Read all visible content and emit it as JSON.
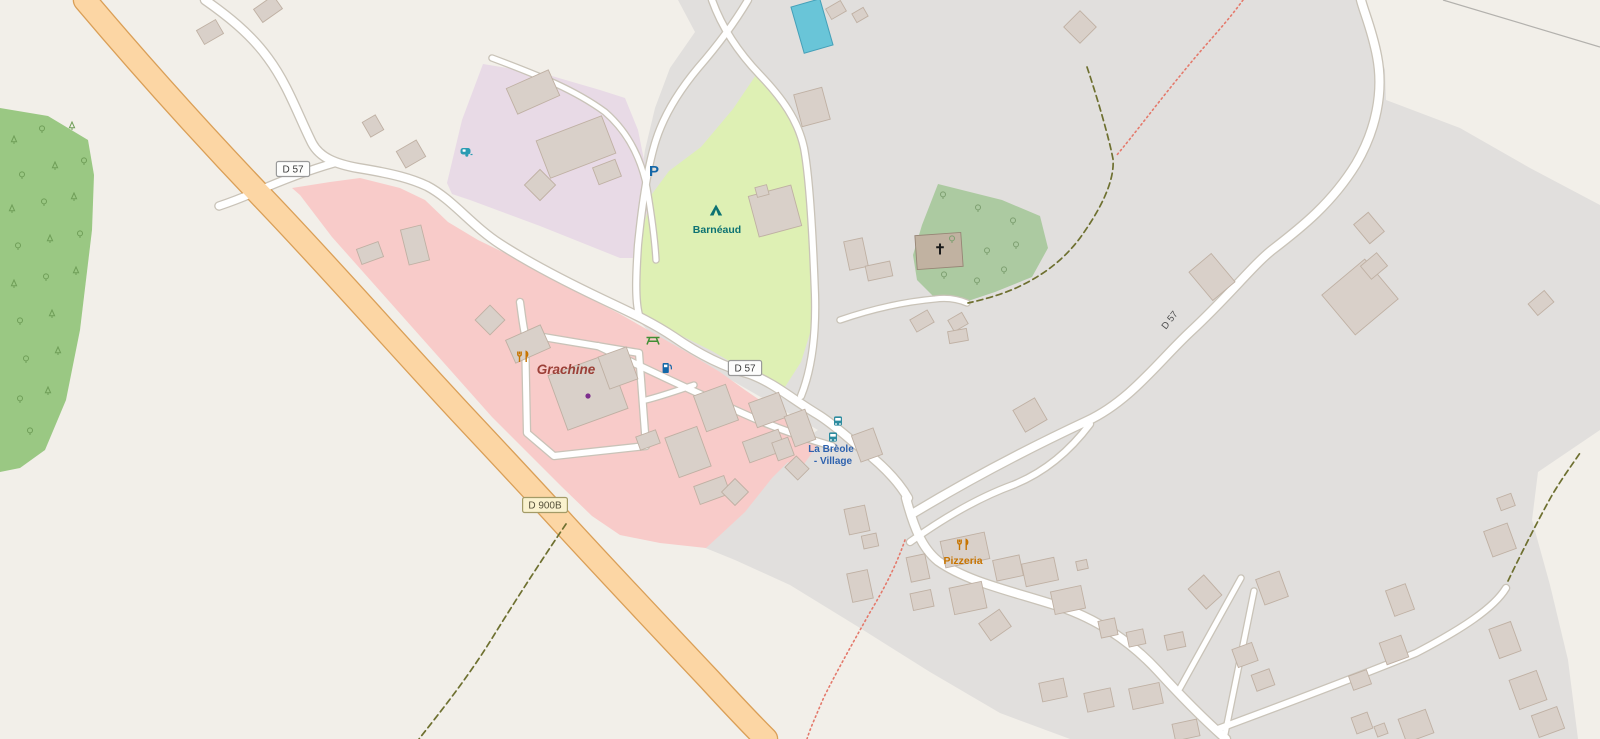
{
  "map": {
    "background": "#f2efe9",
    "building_style": {
      "fill": "#d9d0c9",
      "stroke": "#bfb0a3",
      "church_fill": "#c1b2a1",
      "church_stroke": "#968575"
    },
    "landuse": [
      {
        "name": "residential-gray",
        "fill": "#e1dfdd",
        "points": "678,0 1360,0 1374,35 1385,70 1386,100 1460,128 1530,168 1600,205 1600,430 1538,472 1532,520 1550,585 1568,660 1578,739 1070,739 1000,713 930,672 860,628 790,585 735,560 703,547 780,462 800,442 818,430 790,414 745,388 700,362 655,338 636,318 634,260 638,200 645,150 655,108 670,68 695,32"
      },
      {
        "name": "forest",
        "fill": "#9ac883",
        "points": "0,108 48,116 88,140 94,175 92,230 80,330 66,400 45,450 20,468 0,472"
      },
      {
        "name": "pink-hamlet",
        "fill": "#f8cbc9",
        "points": "292,188 330,182 360,178 400,188 425,200 448,222 478,240 515,258 550,276 585,296 620,314 655,334 690,354 720,372 745,390 770,407 790,422 806,434 818,444 800,470 788,462 772,478 745,512 718,537 706,548 660,543 620,535 592,516 562,487 527,452 492,417 452,372 412,327 372,282 332,237 300,195"
      },
      {
        "name": "lavender-caravan-site",
        "fill": "#e8dae6",
        "points": "483,64 545,74 600,90 625,98 638,130 648,180 656,228 657,258 620,258 540,226 470,200 452,194 447,183 462,120"
      },
      {
        "name": "camp-site-green",
        "fill": "#def0b4",
        "points": "758,72 786,112 800,142 807,172 811,232 813,290 811,330 801,362 783,390 755,376 712,351 668,329 641,315 635,294 640,240 652,194 669,171 701,147 733,109"
      },
      {
        "name": "church-wood",
        "fill": "#accaa1",
        "points": "938,184 1002,200 1040,216 1048,248 1032,277 995,292 965,302 935,298 917,280 913,255 922,225"
      }
    ],
    "pool": {
      "x": 797,
      "y": 2,
      "w": 30,
      "h": 48,
      "rot": -16,
      "fill": "#69c5d8",
      "stroke": "#45a0b8"
    },
    "powerline": {
      "x1": 1443,
      "y1": 0,
      "x2": 1600,
      "y2": 47,
      "color": "#b3b1ad"
    },
    "roads": [
      {
        "name": "d57-west",
        "d": "M 205,0 C 225,14 250,33 268,58 C 288,85 298,115 312,143 C 320,158 336,164 358,168 C 395,174 412,179 427,186 C 452,199 472,226 500,244 C 528,262 562,280 602,299 C 627,311 650,321 674,337 C 697,353 724,367 750,374 C 774,383 792,399 817,414 C 832,423 847,437 862,449 C 880,463 897,479 908,498",
        "width": 8
      },
      {
        "name": "d57-branch-to-d900b",
        "d": "M 334,163 C 306,171 276,183 253,193 C 239,199 228,203 219,206",
        "width": 7
      },
      {
        "name": "d57-northeast",
        "d": "M 912,514 C 950,491 1012,456 1087,421 C 1130,401 1158,362 1190,332 C 1228,297 1252,266 1272,250 C 1302,227 1332,203 1356,164 C 1376,130 1384,92 1377,56 C 1372,30 1364,12 1361,0",
        "width": 8
      },
      {
        "name": "village-southeast",
        "d": "M 906,498 C 914,528 922,548 938,561 C 968,582 1008,590 1058,606 C 1100,620 1133,644 1158,671 C 1178,693 1198,714 1226,739",
        "width": 8
      },
      {
        "name": "village-ne-link",
        "d": "M 910,542 C 945,517 980,497 1013,485 C 1048,471 1072,448 1090,424",
        "width": 6
      },
      {
        "name": "grachine-link",
        "d": "M 598,346 C 640,366 692,391 742,413 C 777,429 808,439 832,446",
        "width": 6
      },
      {
        "name": "grachine-loop",
        "d": "M 520,302 C 522,316 523,326 525,334 L 639,353 L 646,446 L 554,456 L 527,433 L 525,334",
        "width": 6
      },
      {
        "name": "grachine-spur",
        "d": "M 646,400 C 662,396 676,391 694,385",
        "width": 5
      },
      {
        "name": "camp-east-lane",
        "d": "M 712,0 C 722,28 738,52 760,75 C 782,98 798,120 804,148 C 810,180 813,240 815,295 C 816,330 813,366 801,396",
        "width": 6
      },
      {
        "name": "camp-west-lane",
        "d": "M 748,0 C 735,22 718,45 698,68 C 678,92 664,115 656,140 C 648,165 642,205 638,245 C 636,275 635,300 639,315",
        "width": 6
      },
      {
        "name": "caravan-site-lane",
        "d": "M 492,58 C 540,76 575,90 605,112 C 628,132 641,158 647,188 C 652,218 655,242 656,260",
        "width": 5
      },
      {
        "name": "church-lane",
        "d": "M 840,320 C 872,309 902,302 935,299 C 950,297 960,300 967,303",
        "width": 5
      },
      {
        "name": "branch-a",
        "d": "M 1180,688 L 1241,578",
        "width": 5
      },
      {
        "name": "branch-b",
        "d": "M 1224,739 L 1254,591",
        "width": 5
      },
      {
        "name": "se-deadend-lane",
        "d": "M 1218,729 C 1280,706 1352,679 1416,653 C 1462,629 1494,608 1506,588",
        "width": 6
      },
      {
        "name": "d900b-primary",
        "d": "M 85,0 C 140,65 200,132 265,200 C 330,268 395,342 460,412 C 505,460 535,492 565,525 C 610,574 660,627 710,680 C 733,705 752,725 766,739",
        "width": 22,
        "fill": "#fcd6a4",
        "casing": "#da9f57"
      }
    ],
    "tracks": [
      {
        "name": "footpath-northeast",
        "d": "M 1243,0 C 1225,25 1204,46 1184,71 C 1159,101 1133,136 1116,156",
        "color": "#e4796b",
        "dash": "1.5,3.2",
        "width": 1.6
      },
      {
        "name": "track-church-hill",
        "d": "M 1087,67 C 1098,100 1109,138 1113,159 C 1115,183 1098,213 1080,238 C 1062,262 1040,277 1016,288 C 1000,295 982,300 968,303",
        "color": "#6e7030",
        "dash": "6,4",
        "width": 1.7
      },
      {
        "name": "footpath-south",
        "d": "M 905,540 C 896,566 884,589 869,614 C 854,641 839,667 824,697 C 815,718 810,729 807,739",
        "color": "#e4796b",
        "dash": "1.5,3.2",
        "width": 1.6
      },
      {
        "name": "track-southwest",
        "d": "M 566,524 C 541,561 515,601 491,640 C 466,680 441,711 419,739",
        "color": "#6e7030",
        "dash": "6,4",
        "width": 1.7
      },
      {
        "name": "track-southeast",
        "d": "M 1508,581 C 1520,556 1536,524 1551,497 C 1562,478 1572,465 1580,453",
        "color": "#6e7030",
        "dash": "6,4",
        "width": 1.7
      }
    ],
    "buildings": [
      [
        268,
        9,
        24,
        16,
        -35
      ],
      [
        210,
        32,
        22,
        16,
        -30
      ],
      [
        373,
        126,
        15,
        17,
        -30
      ],
      [
        411,
        154,
        23,
        19,
        -30
      ],
      [
        533,
        92,
        46,
        28,
        -24
      ],
      [
        576,
        147,
        70,
        40,
        -21
      ],
      [
        607,
        172,
        24,
        18,
        -21
      ],
      [
        540,
        185,
        22,
        22,
        45
      ],
      [
        812,
        107,
        29,
        33,
        -15
      ],
      [
        836,
        10,
        17,
        12,
        -30
      ],
      [
        860,
        15,
        13,
        10,
        -30
      ],
      [
        775,
        211,
        44,
        42,
        -15
      ],
      [
        762,
        191,
        12,
        10,
        -15
      ],
      [
        1080,
        27,
        23,
        23,
        45
      ],
      [
        1212,
        277,
        29,
        37,
        -40
      ],
      [
        1360,
        297,
        56,
        52,
        -40
      ],
      [
        1374,
        266,
        21,
        17,
        -40
      ],
      [
        1369,
        228,
        19,
        25,
        -40
      ],
      [
        1541,
        303,
        21,
        15,
        -40
      ],
      [
        856,
        254,
        19,
        29,
        -12
      ],
      [
        879,
        271,
        25,
        15,
        -12
      ],
      [
        922,
        321,
        20,
        14,
        -30
      ],
      [
        958,
        322,
        16,
        13,
        -30
      ],
      [
        939,
        251,
        46,
        34,
        -4,
        "c"
      ],
      [
        490,
        320,
        21,
        21,
        45
      ],
      [
        528,
        344,
        38,
        25,
        -24
      ],
      [
        588,
        392,
        64,
        58,
        -20
      ],
      [
        415,
        245,
        21,
        36,
        -14
      ],
      [
        370,
        253,
        23,
        16,
        -20
      ],
      [
        618,
        368,
        30,
        34,
        -20
      ],
      [
        716,
        408,
        34,
        38,
        -20
      ],
      [
        688,
        452,
        34,
        42,
        -20
      ],
      [
        712,
        490,
        32,
        19,
        -20
      ],
      [
        764,
        446,
        38,
        22,
        -20
      ],
      [
        648,
        440,
        21,
        14,
        -20
      ],
      [
        735,
        492,
        19,
        19,
        45
      ],
      [
        768,
        410,
        32,
        26,
        -20
      ],
      [
        800,
        428,
        22,
        32,
        -20
      ],
      [
        783,
        449,
        17,
        19,
        -20
      ],
      [
        797,
        468,
        18,
        16,
        45
      ],
      [
        867,
        445,
        23,
        28,
        -20
      ],
      [
        857,
        520,
        21,
        26,
        -12
      ],
      [
        870,
        541,
        15,
        13,
        -12
      ],
      [
        965,
        550,
        45,
        27,
        -12
      ],
      [
        1008,
        568,
        27,
        21,
        -12
      ],
      [
        968,
        598,
        33,
        27,
        -12
      ],
      [
        995,
        625,
        25,
        21,
        -35
      ],
      [
        918,
        568,
        19,
        25,
        -12
      ],
      [
        922,
        600,
        21,
        17,
        -12
      ],
      [
        860,
        586,
        21,
        29,
        -12
      ],
      [
        958,
        336,
        19,
        12,
        -10
      ],
      [
        1030,
        415,
        25,
        25,
        -30
      ],
      [
        1040,
        572,
        33,
        23,
        -12
      ],
      [
        1068,
        600,
        31,
        23,
        -12
      ],
      [
        1108,
        628,
        17,
        17,
        -12
      ],
      [
        1136,
        638,
        17,
        15,
        -12
      ],
      [
        1175,
        641,
        19,
        15,
        -12
      ],
      [
        1205,
        592,
        21,
        27,
        -42
      ],
      [
        1272,
        588,
        25,
        27,
        -20
      ],
      [
        1245,
        655,
        21,
        19,
        -20
      ],
      [
        1263,
        680,
        19,
        17,
        -20
      ],
      [
        1053,
        690,
        25,
        19,
        -12
      ],
      [
        1099,
        700,
        27,
        19,
        -12
      ],
      [
        1146,
        696,
        31,
        21,
        -12
      ],
      [
        1186,
        730,
        25,
        17,
        -12
      ],
      [
        1082,
        565,
        11,
        9,
        -12
      ],
      [
        1400,
        600,
        21,
        27,
        -20
      ],
      [
        1394,
        650,
        23,
        23,
        -20
      ],
      [
        1360,
        680,
        19,
        15,
        -20
      ],
      [
        1362,
        723,
        17,
        17,
        -20
      ],
      [
        1381,
        730,
        11,
        11,
        -20
      ],
      [
        1416,
        726,
        29,
        25,
        -20
      ],
      [
        1505,
        640,
        23,
        31,
        -20
      ],
      [
        1528,
        690,
        29,
        31,
        -20
      ],
      [
        1548,
        722,
        27,
        23,
        -20
      ],
      [
        1500,
        540,
        25,
        27,
        -20
      ],
      [
        1506,
        502,
        15,
        13,
        -20
      ]
    ],
    "trees": {
      "forest_color": "#6f9e58",
      "church_color": "#7d9f70",
      "forest": [
        [
          14,
          141,
          "c"
        ],
        [
          42,
          130,
          "b"
        ],
        [
          72,
          127,
          "c"
        ],
        [
          22,
          176,
          "b"
        ],
        [
          55,
          167,
          "c"
        ],
        [
          84,
          162,
          "b"
        ],
        [
          12,
          210,
          "c"
        ],
        [
          44,
          203,
          "b"
        ],
        [
          74,
          198,
          "c"
        ],
        [
          18,
          247,
          "b"
        ],
        [
          50,
          240,
          "c"
        ],
        [
          80,
          235,
          "b"
        ],
        [
          14,
          285,
          "c"
        ],
        [
          46,
          278,
          "b"
        ],
        [
          76,
          272,
          "c"
        ],
        [
          20,
          322,
          "b"
        ],
        [
          52,
          315,
          "c"
        ],
        [
          26,
          360,
          "b"
        ],
        [
          58,
          352,
          "c"
        ],
        [
          20,
          400,
          "b"
        ],
        [
          48,
          392,
          "c"
        ],
        [
          30,
          432,
          "b"
        ]
      ],
      "church": [
        [
          943,
          196
        ],
        [
          978,
          209
        ],
        [
          1013,
          222
        ],
        [
          952,
          240
        ],
        [
          987,
          252
        ],
        [
          1016,
          246
        ],
        [
          944,
          276
        ],
        [
          977,
          282
        ],
        [
          1004,
          271
        ]
      ]
    },
    "icons": [
      {
        "type": "restaurant",
        "x": 523,
        "y": 357,
        "color": "#c77400"
      },
      {
        "type": "restaurant",
        "x": 963,
        "y": 545,
        "color": "#c77400"
      },
      {
        "type": "picnic",
        "x": 653,
        "y": 340,
        "color": "#3f8f34"
      },
      {
        "type": "fuel",
        "x": 666,
        "y": 368,
        "color": "#1467a8"
      },
      {
        "type": "parking",
        "x": 654,
        "y": 171,
        "color": "#1467a8"
      },
      {
        "type": "caravan",
        "x": 466,
        "y": 152,
        "color": "#2b9cb3"
      },
      {
        "type": "tent",
        "x": 716,
        "y": 211,
        "color": "#0d7272"
      },
      {
        "type": "bus",
        "x": 838,
        "y": 421,
        "color": "#2e8ca0"
      },
      {
        "type": "bus",
        "x": 833,
        "y": 437,
        "color": "#2e8ca0"
      },
      {
        "type": "cross",
        "x": 940,
        "y": 250,
        "color": "#1a1a1a"
      },
      {
        "type": "dot",
        "x": 588,
        "y": 396,
        "color": "#7d2e8d"
      }
    ],
    "labels": [
      {
        "id": "grachine",
        "text": "Grachine",
        "x": 566,
        "y": 374,
        "size": 13.5,
        "color": "#9c4038",
        "italic": true,
        "weight": "600"
      },
      {
        "id": "barneaud",
        "text": "Barnéaud",
        "x": 717,
        "y": 233,
        "size": 10.5,
        "color": "#0d7272",
        "weight": "600"
      },
      {
        "id": "breole-1",
        "text": "La Brèole",
        "x": 831,
        "y": 452,
        "size": 10,
        "color": "#2e62ae",
        "weight": "600"
      },
      {
        "id": "breole-2",
        "text": "- Village",
        "x": 833,
        "y": 464,
        "size": 10,
        "color": "#2e62ae",
        "weight": "600"
      },
      {
        "id": "pizzeria",
        "text": "Pizzeria",
        "x": 963,
        "y": 564,
        "size": 10.5,
        "color": "#c77400",
        "weight": "600"
      },
      {
        "id": "d57-rotated",
        "text": "D 57",
        "x": 1172,
        "y": 322,
        "size": 9.5,
        "color": "#4d4d4d",
        "rot": -52
      }
    ],
    "shields": [
      {
        "text": "D 57",
        "x": 293,
        "y": 169,
        "style": "white"
      },
      {
        "text": "D 57",
        "x": 745,
        "y": 368,
        "style": "white"
      },
      {
        "text": "D 900B",
        "x": 545,
        "y": 505,
        "style": "yellow"
      }
    ],
    "shield_styles": {
      "white": {
        "fill": "#fdfdfc",
        "stroke": "#9a9a9a",
        "text": "#3c3c3c"
      },
      "yellow": {
        "fill": "#faf2cf",
        "stroke": "#a39b67",
        "text": "#55503a"
      }
    }
  }
}
